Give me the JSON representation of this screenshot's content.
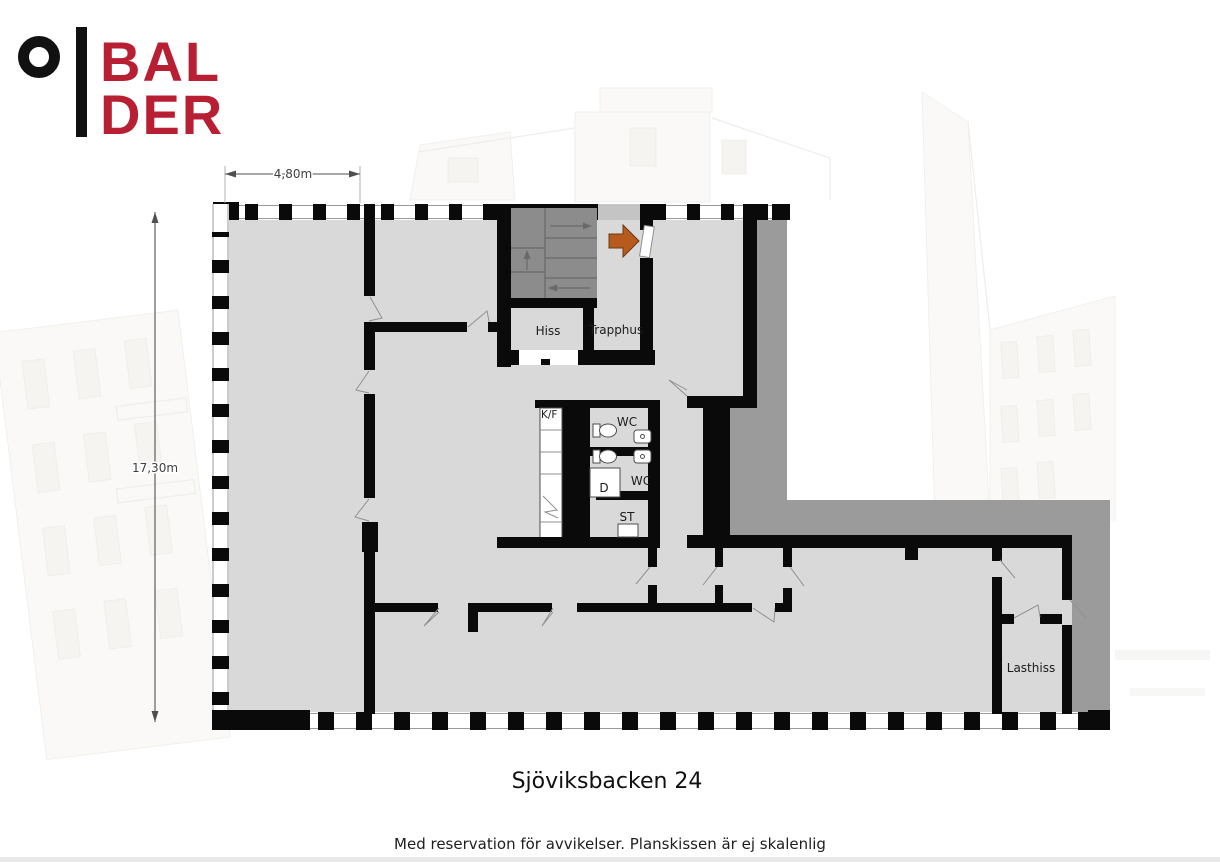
{
  "brand": {
    "line1": "BAL",
    "line2": "DER"
  },
  "plan": {
    "dim_width": "4,80m",
    "dim_height": "17,30m",
    "rooms": {
      "hiss": "Hiss",
      "trapphus": "Trapphus",
      "kf": "K/F",
      "wc_top": "WC",
      "wc_bottom": "WC",
      "shower": "D",
      "storage": "ST",
      "lasthiss": "Lasthiss"
    }
  },
  "footer": {
    "title": "Sjöviksbacken 24",
    "disclaimer": "Med reservation för avvikelser. Planskissen är ej skalenlig"
  },
  "colors": {
    "floor": "#d9d9d9",
    "adjacent": "#9b9b9b",
    "stairs": "#8c8c8c",
    "wall": "#0a0a0a",
    "arrow": "#b65a1d",
    "brand_red": "#b81f33"
  }
}
